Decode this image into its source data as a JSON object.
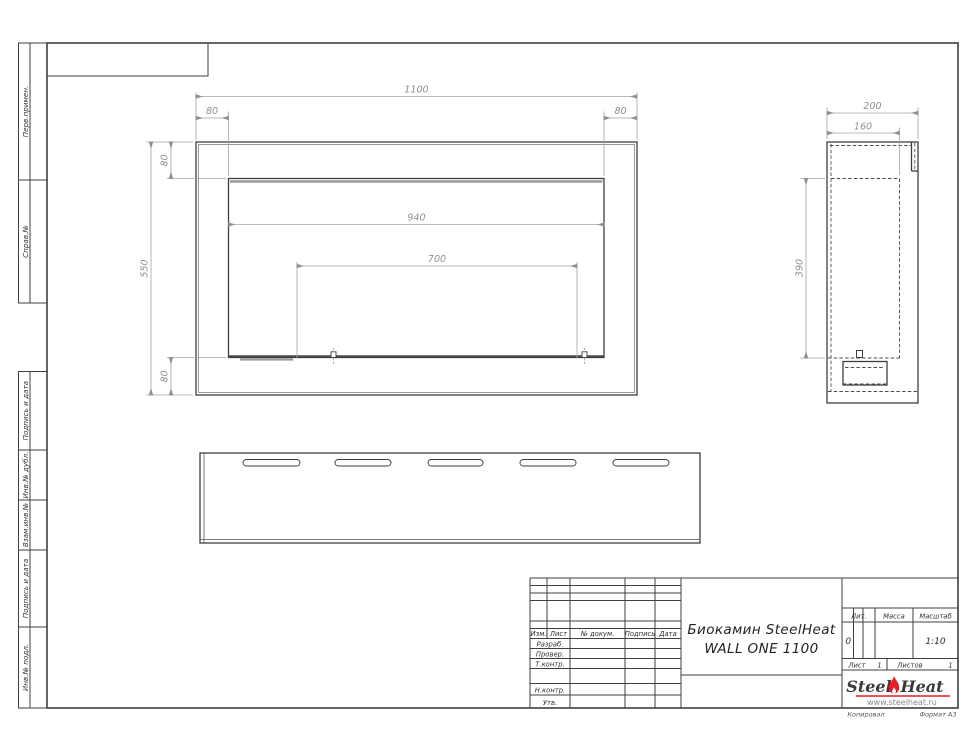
{
  "margin_labels": {
    "perv_primen": "Перв.примен.",
    "sprav_no": "Справ.№",
    "podpis_data_1": "Подпись и дата",
    "inv_dubl": "Инв.№ дубл.",
    "vzam_inv": "Взам.инв.№",
    "podpis_data_2": "Подпись и дата",
    "inv_podl": "Инв.№ подл."
  },
  "dims": {
    "front_width": "1100",
    "front_offset_left": "80",
    "front_offset_right": "80",
    "front_offset_top": "80",
    "front_height": "550",
    "front_offset_bottom": "80",
    "front_opening_width": "940",
    "front_mount_spacing": "700",
    "side_depth": "200",
    "side_inner_depth": "160",
    "side_inner_height": "390"
  },
  "title_block": {
    "header_cols": [
      "Изм.",
      "Лист",
      "№ докум.",
      "Подпись",
      "Дата"
    ],
    "rows": [
      "Разраб.",
      "Провер.",
      "Т.контр.",
      "Н.контр.",
      "Утв."
    ],
    "product_line1": "Биокамин SteelHeat",
    "product_line2": "WALL ONE 1100",
    "lit_label": "Лит.",
    "lit_value": "0",
    "mass_label": "Масса",
    "scale_label": "Масштаб",
    "scale_value": "1:10",
    "sheet_label": "Лист",
    "sheet_value": "1",
    "sheets_label": "Листов",
    "sheets_value": "1"
  },
  "logo": {
    "steel": "Steel",
    "heat": "Heat",
    "url": "www.steelheat.ru"
  },
  "footer": {
    "copied": "Копировал",
    "format": "Формат А3"
  },
  "colors": {
    "accent_red": "#e31e24",
    "line_dark": "#3f3f3f",
    "line_dim": "#a3a3a3"
  }
}
